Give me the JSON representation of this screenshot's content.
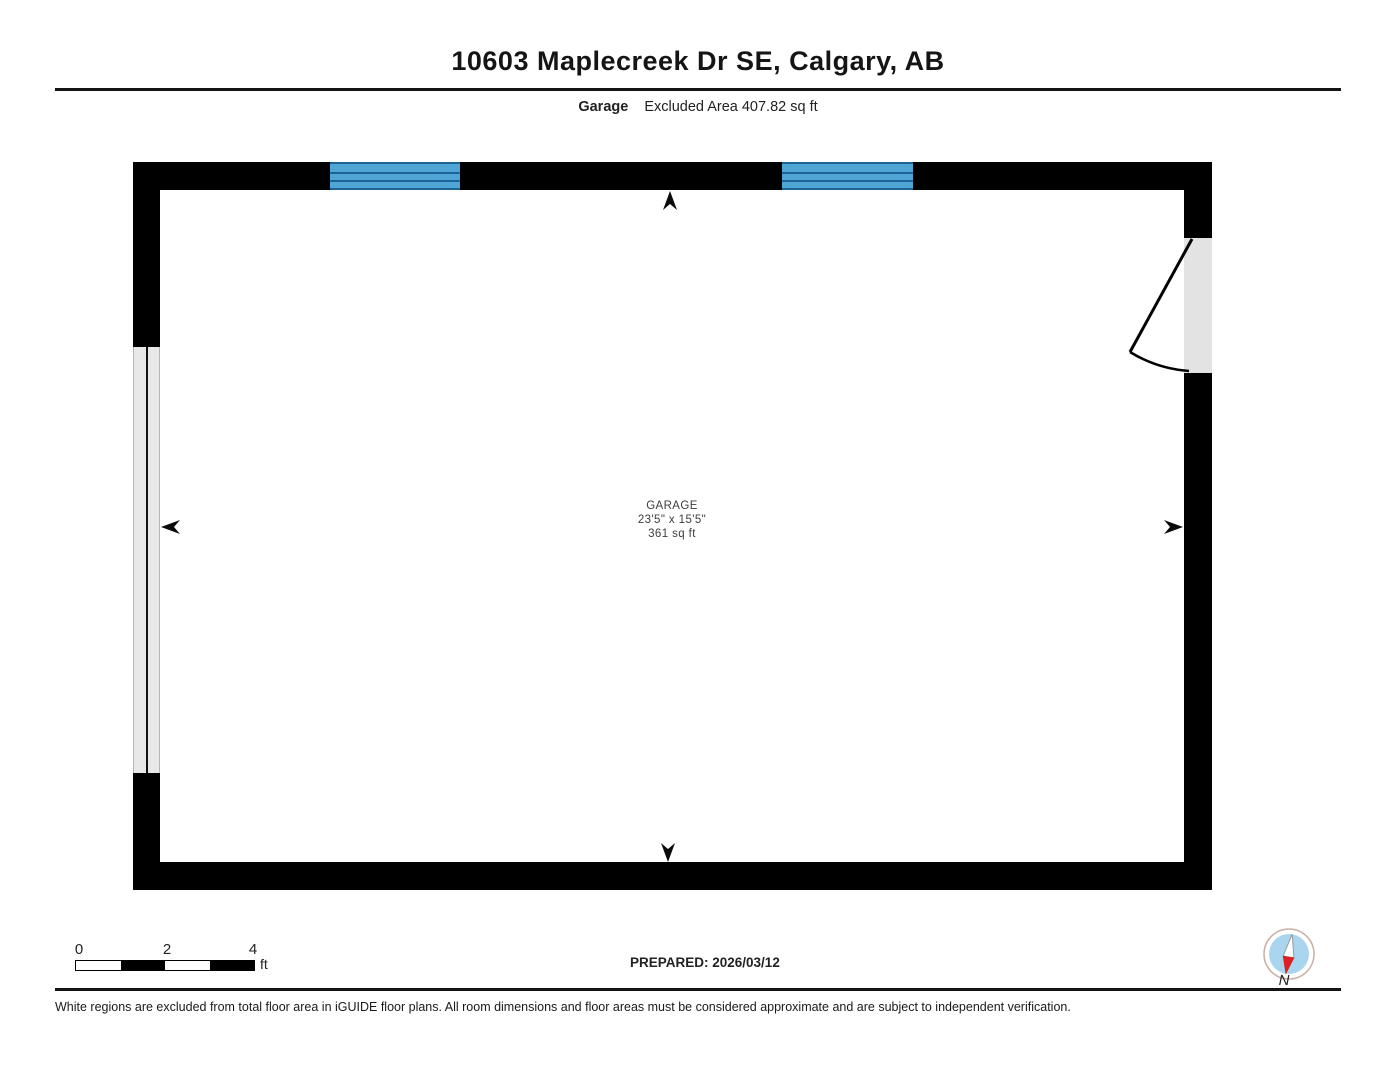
{
  "header": {
    "title": "10603 Maplecreek Dr SE, Calgary, AB",
    "floor_label": "Garage",
    "area_note": "Excluded Area 407.82 sq ft"
  },
  "floorplan": {
    "room": {
      "name": "GARAGE",
      "dimensions": "23'5\" x 15'5\"",
      "area": "361 sq ft"
    },
    "colors": {
      "wall": "#000000",
      "window_fill": "#4fa5d6",
      "window_mullion": "#1c6494",
      "door_opening_fill": "#e3e3e3",
      "garage_door_fill": "#e8e8e8",
      "compass_blue": "#a9d5ee",
      "compass_red": "#e02020"
    }
  },
  "scale_bar": {
    "ticks": [
      "0",
      "2",
      "4"
    ],
    "unit": "ft"
  },
  "footer": {
    "prepared": "PREPARED: 2026/03/12",
    "compass_label": "N",
    "disclaimer": "White regions are excluded from total floor area in iGUIDE floor plans. All room dimensions and floor areas must be considered approximate and are subject to independent verification."
  }
}
